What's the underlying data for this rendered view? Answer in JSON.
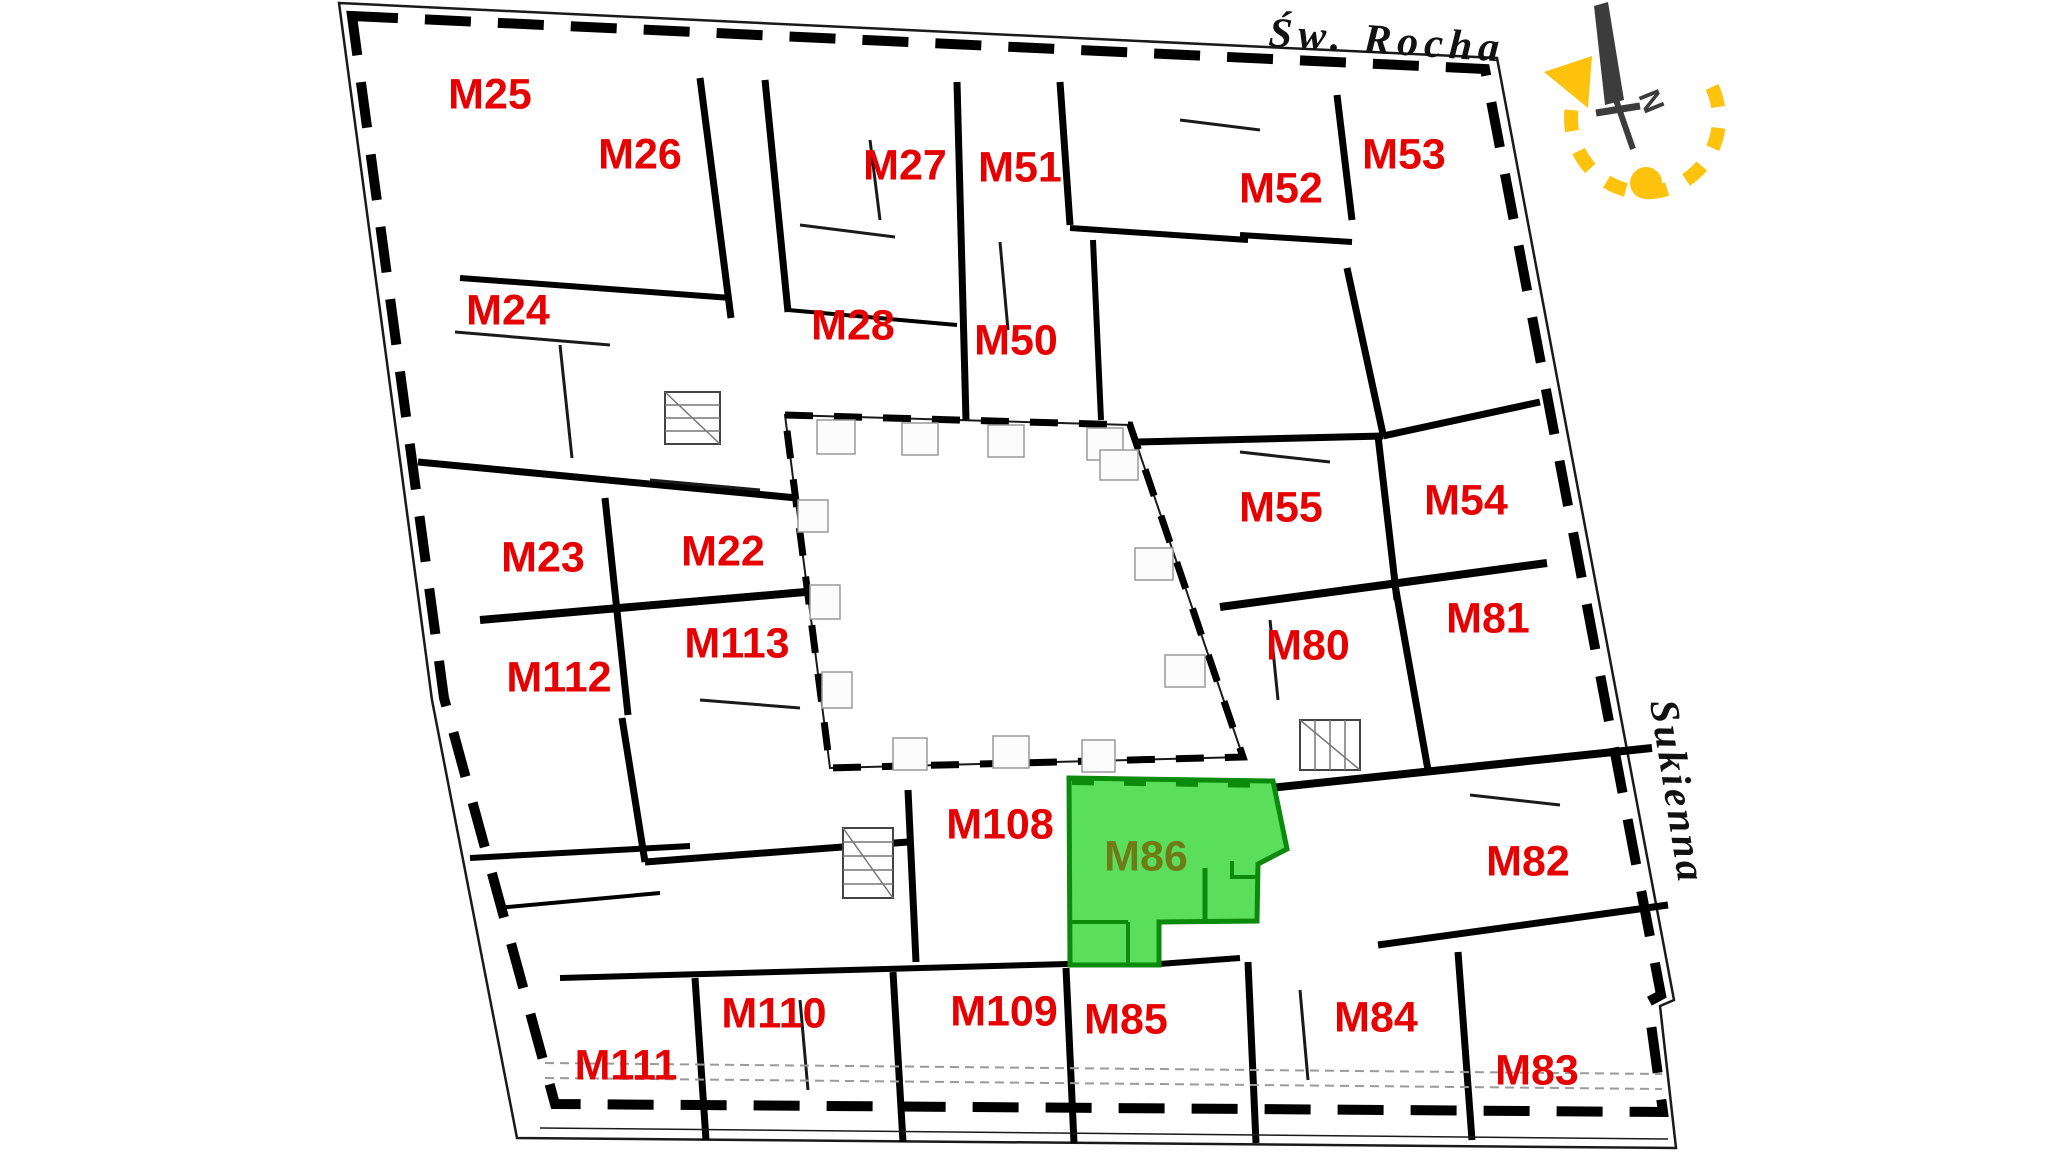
{
  "plan": {
    "description": "apartment-building-floor-plan",
    "streets": {
      "top": "Św. Rocha",
      "right": "Sukienna"
    },
    "compass": {
      "north_label": "N"
    },
    "highlighted_apartment": {
      "id": "M86"
    },
    "colors": {
      "label_red": "#e60000",
      "highlight_fill": "#5bde5b",
      "highlight_border": "#0b8a0b",
      "highlight_label": "#6f7c15",
      "wall_black": "#000000",
      "compass_needle": "#3c3c3c",
      "sun_yellow": "#ffc20d",
      "background": "#ffffff"
    },
    "apartments": [
      {
        "id": "M25",
        "x": 490,
        "y": 97,
        "highlighted": false
      },
      {
        "id": "M26",
        "x": 640,
        "y": 157,
        "highlighted": false
      },
      {
        "id": "M27",
        "x": 905,
        "y": 168,
        "highlighted": false
      },
      {
        "id": "M51",
        "x": 1020,
        "y": 170,
        "highlighted": false
      },
      {
        "id": "M52",
        "x": 1281,
        "y": 191,
        "highlighted": false
      },
      {
        "id": "M53",
        "x": 1404,
        "y": 157,
        "highlighted": false
      },
      {
        "id": "M24",
        "x": 508,
        "y": 313,
        "highlighted": false
      },
      {
        "id": "M28",
        "x": 853,
        "y": 328,
        "highlighted": false
      },
      {
        "id": "M50",
        "x": 1016,
        "y": 343,
        "highlighted": false
      },
      {
        "id": "M23",
        "x": 543,
        "y": 560,
        "highlighted": false
      },
      {
        "id": "M22",
        "x": 723,
        "y": 554,
        "highlighted": false
      },
      {
        "id": "M55",
        "x": 1281,
        "y": 510,
        "highlighted": false
      },
      {
        "id": "M54",
        "x": 1466,
        "y": 503,
        "highlighted": false
      },
      {
        "id": "M113",
        "x": 737,
        "y": 646,
        "highlighted": false
      },
      {
        "id": "M112",
        "x": 559,
        "y": 680,
        "highlighted": false
      },
      {
        "id": "M80",
        "x": 1308,
        "y": 648,
        "highlighted": false
      },
      {
        "id": "M81",
        "x": 1488,
        "y": 621,
        "highlighted": false
      },
      {
        "id": "M108",
        "x": 1000,
        "y": 827,
        "highlighted": false
      },
      {
        "id": "M86",
        "x": 1146,
        "y": 859,
        "highlighted": true
      },
      {
        "id": "M82",
        "x": 1528,
        "y": 864,
        "highlighted": false
      },
      {
        "id": "M110",
        "x": 774,
        "y": 1016,
        "highlighted": false
      },
      {
        "id": "M109",
        "x": 1004,
        "y": 1014,
        "highlighted": false
      },
      {
        "id": "M85",
        "x": 1126,
        "y": 1022,
        "highlighted": false
      },
      {
        "id": "M84",
        "x": 1376,
        "y": 1020,
        "highlighted": false
      },
      {
        "id": "M111",
        "x": 626,
        "y": 1068,
        "highlighted": false
      },
      {
        "id": "M83",
        "x": 1537,
        "y": 1073,
        "highlighted": false
      }
    ]
  }
}
